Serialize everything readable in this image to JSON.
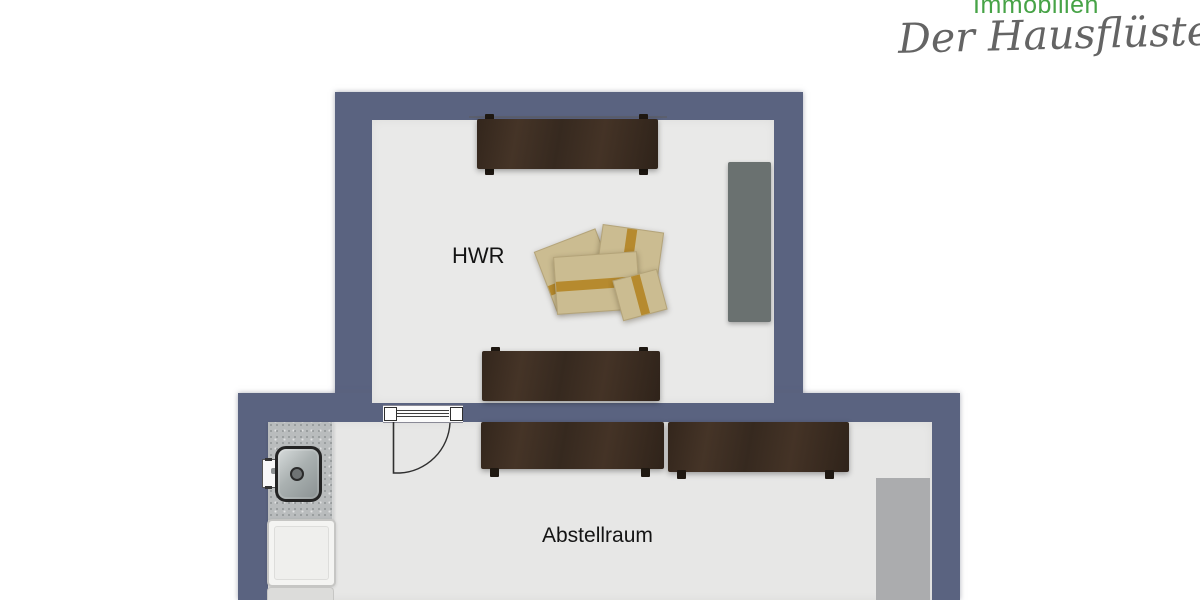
{
  "logo": {
    "brand": "Immobilien",
    "tagline": "Der Hausflüsterer",
    "brand_color": "#47a347",
    "tagline_color": "#646464"
  },
  "floorplan": {
    "wall_color": "#5a6380",
    "floor_color_hwr": "#e9e9e8",
    "floor_color_abstellraum": "#e7e7e6",
    "rooms": {
      "hwr": {
        "label": "HWR"
      },
      "abstellraum": {
        "label": "Abstellraum"
      }
    },
    "colors": {
      "wood_shelf": "#3b2c21",
      "cardboard_box": "#cbbc91",
      "packing_tape": "#b68a2e",
      "tall_cabinet": "#6a7170",
      "storage_block": "#abacae",
      "counter": "#b9bcbd",
      "appliance": "#f4f4f2"
    },
    "furniture_items": [
      "wall-shelf-top",
      "tall-cabinet",
      "moving-boxes",
      "wall-shelf-bottom",
      "counter-with-sink",
      "appliance",
      "appliance-lower",
      "interior-door",
      "storage-shelf-left",
      "storage-shelf-right",
      "storage-block"
    ]
  }
}
